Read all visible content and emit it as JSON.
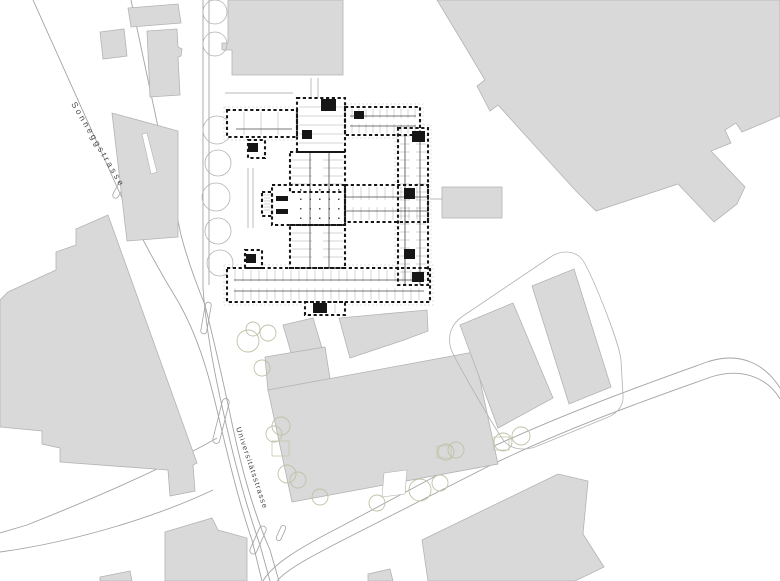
{
  "map": {
    "width": 780,
    "height": 581,
    "colors": {
      "background": "#ffffff",
      "building_fill": "#d9d9d9",
      "building_stroke": "#b3b3b3",
      "street_stroke": "#a3a3a3",
      "tree_gray": "#b3b3b3",
      "tree_green": "#bcc3a6",
      "plan_wall": "#161616",
      "plan_corridor": "#4a4a4a",
      "plan_detail": "#ababab",
      "plan_halo": "#d9d9d9",
      "label_color": "#4a4a4a"
    },
    "streets": [
      {
        "name": "sonneggstrasse",
        "label": "Sonneggstrasse"
      },
      {
        "name": "universitaetsstrasse",
        "label": "Universitätsstrasse"
      }
    ],
    "street_paths": [
      "M33,0 L122,198 C142,240 160,272 179,303 C198,337 208,372 217,410 C226,448 238,500 252,540 L262,581",
      "M131,0 L181,235 C188,262 196,283 205,305",
      "M203,0 L203,288 C206,330 214,372 224,415 C234,460 247,508 260,545 L270,581",
      "M209,0 L209,285",
      "M205,305 C215,345 224,385 233,428 C243,475 256,518 270,550 L279,581",
      "M217,438 C175,462 110,492 27,525 L0,533",
      "M213,490 C160,515 80,541 0,552",
      "M263,581 C272,565 297,549 340,527 L479,453 C566,412 657,380 707,362 C743,350 767,367 780,388",
      "M277,581 C287,569 312,556 347,538 L489,466 C573,425 658,396 711,377 C745,366 770,381 780,399"
    ],
    "islands": [
      [
        206,
        318,
        6,
        32,
        10
      ],
      [
        221,
        421,
        7,
        46,
        14
      ],
      [
        119,
        189,
        6,
        20,
        28
      ],
      [
        258,
        540,
        7,
        30,
        24
      ],
      [
        281,
        533,
        5,
        16,
        24
      ]
    ],
    "buildings": [
      "128,8 178,4 181,23 131,27",
      "100,32 124,29 127,56 103,59",
      "147,31 177,29 178,47 182,49 181,56 178,57 180,95 150,97",
      "112,113 178,131 178,237 127,241",
      "0,300 8,292 56,270 56,252 76,245 76,229 108,215 197,463 193,465 195,491 170,496 168,470 60,462 60,448 42,444 42,431 0,427",
      "228,0 343,0 343,75 232,75 232,50 222,50 222,43 228,43",
      "437,0 780,0 780,116 742,132 736,123 725,130 731,143 711,151 745,187 737,204 714,222 678,184 596,211 575,190 498,105 490,111 477,86 485,80 469,53",
      "442,187 502,187 502,218 442,218",
      "283,325 313,318 328,368 297,373",
      "339,318 427,310 428,331 404,340 350,358",
      "265,357 325,347 331,385 268,391",
      "268,390 474,352 498,464 292,502",
      "460,325 513,303 553,398 498,428",
      "532,286 574,269 611,387 569,404",
      "422,540 558,474 588,481 583,534 604,567 575,581 428,581",
      "165,532 212,518 218,530 247,538 247,581 165,581",
      "368,574 390,569 393,581 368,581",
      "100,577 130,571 132,581 100,581"
    ],
    "white_notches": [
      "142,134 147,133 157,172 151,174",
      "382,497 384,473 407,470 405,494"
    ],
    "plot_outline": "M451,349 C447,336 451,324 463,316 L549,258 C560,250 573,250 581,258 C589,266 619,341 621,360 L623,395 C624,406 617,414 606,418 L535,447 C523,451 511,449 504,441 C497,432 456,362 451,349 Z",
    "trees": {
      "gray": [
        [
          215,
          12,
          12
        ],
        [
          215,
          44,
          12
        ],
        [
          217,
          130,
          14
        ],
        [
          218,
          163,
          13
        ],
        [
          216,
          197,
          14
        ],
        [
          218,
          231,
          13
        ],
        [
          220,
          263,
          13
        ]
      ],
      "green": [
        [
          248,
          341,
          11
        ],
        [
          253,
          329,
          7
        ],
        [
          268,
          333,
          8
        ],
        [
          262,
          368,
          8
        ],
        [
          281,
          426,
          9
        ],
        [
          274,
          434,
          8
        ],
        [
          287,
          474,
          9
        ],
        [
          298,
          480,
          8
        ],
        [
          320,
          497,
          8
        ],
        [
          377,
          503,
          8
        ],
        [
          420,
          490,
          11
        ],
        [
          440,
          483,
          8
        ],
        [
          446,
          452,
          8
        ],
        [
          456,
          450,
          8
        ],
        [
          503,
          442,
          9
        ],
        [
          521,
          436,
          9
        ]
      ]
    },
    "tree_squares": [
      [
        272,
        441,
        17,
        15
      ],
      [
        437,
        446,
        14,
        12
      ],
      [
        494,
        437,
        15,
        13
      ]
    ],
    "misc_lines": [
      "M311,78 L311,100",
      "M318,78 L318,100",
      "M430,199 L461,199",
      "M225,93 L293,93",
      "M248,168 L248,228",
      "M253,168 L253,228"
    ],
    "plan": {
      "wings": [
        {
          "r": [
            227,
            110,
            70,
            27
          ],
          "dir": "v",
          "step": 17,
          "split": false,
          "halo": true
        },
        {
          "r": [
            345,
            107,
            75,
            28
          ],
          "dir": "v",
          "step": 7,
          "split": true,
          "halo": true
        },
        {
          "r": [
            297,
            98,
            48,
            54
          ],
          "dir": "h",
          "step": 9,
          "split": false,
          "halo": false
        },
        {
          "r": [
            290,
            152,
            55,
            40
          ],
          "dir": "h",
          "step": 8,
          "split": true,
          "halo": false
        },
        {
          "r": [
            272,
            185,
            73,
            40
          ],
          "dir": "none",
          "step": 0,
          "split": false,
          "halo": false
        },
        {
          "r": [
            290,
            225,
            55,
            43
          ],
          "dir": "h",
          "step": 8,
          "split": true,
          "halo": false
        },
        {
          "r": [
            345,
            185,
            83,
            37
          ],
          "dir": "v",
          "step": 8,
          "split": true,
          "halo": false
        },
        {
          "r": [
            398,
            128,
            30,
            157
          ],
          "dir": "h",
          "step": 8,
          "split": true,
          "halo": true
        },
        {
          "r": [
            227,
            268,
            203,
            34
          ],
          "dir": "v",
          "step": 8,
          "split": true,
          "halo": true
        },
        {
          "r": [
            305,
            302,
            40,
            13
          ],
          "dir": "v",
          "step": 10,
          "split": false,
          "halo": false
        },
        {
          "r": [
            248,
            140,
            17,
            18
          ],
          "dir": "none",
          "step": 0,
          "split": false,
          "halo": false
        },
        {
          "r": [
            245,
            250,
            17,
            18
          ],
          "dir": "none",
          "step": 0,
          "split": false,
          "halo": false
        },
        {
          "r": [
            262,
            192,
            10,
            24
          ],
          "dir": "h",
          "step": 3,
          "split": false,
          "halo": false
        }
      ],
      "corridors": [
        "M310,152 L310,268",
        "M329,152 L329,268",
        "M345,197 L428,197",
        "M345,211 L428,211",
        "M405,135 L405,285",
        "M420,135 L420,285",
        "M234,280 L424,280",
        "M234,291 L424,291",
        "M350,116 L416,116",
        "M350,126 L416,126",
        "M236,129 L292,129"
      ],
      "dark_blocks": [
        [
          321,
          99,
          15,
          12
        ],
        [
          302,
          130,
          10,
          9
        ],
        [
          354,
          111,
          10,
          8
        ],
        [
          412,
          131,
          13,
          11
        ],
        [
          404,
          188,
          11,
          11
        ],
        [
          404,
          249,
          11,
          10
        ],
        [
          276,
          196,
          12,
          5
        ],
        [
          276,
          209,
          12,
          5
        ],
        [
          313,
          303,
          14,
          10
        ],
        [
          248,
          143,
          10,
          9
        ],
        [
          246,
          254,
          10,
          9
        ],
        [
          412,
          272,
          12,
          10
        ]
      ],
      "columns": {
        "x0": 300,
        "y0": 189,
        "cols": 5,
        "rows": 4,
        "dx": 9.5,
        "dy": 9.5,
        "size": 1.5
      }
    }
  }
}
